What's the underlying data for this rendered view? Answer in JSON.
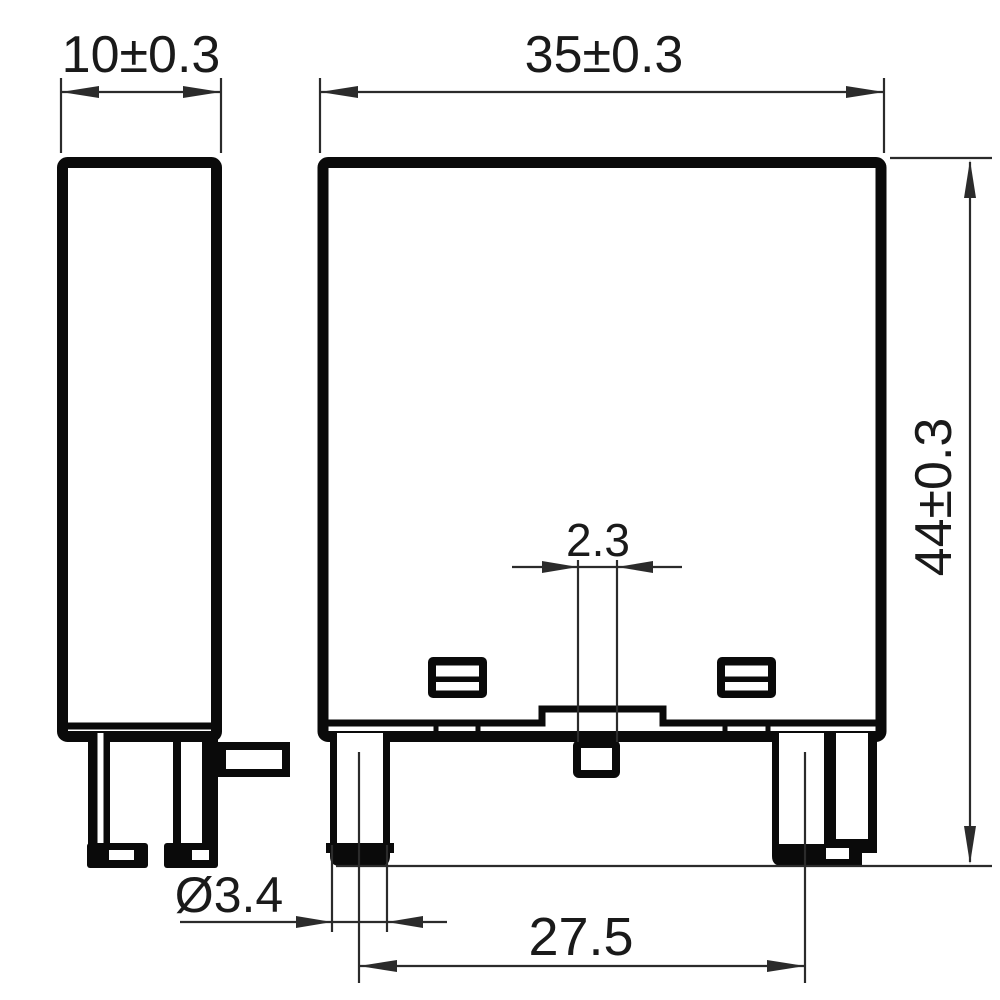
{
  "drawing": {
    "title": "relay-module-dimension-drawing",
    "background_color": "#ffffff",
    "outline_color": "#0a0a0a",
    "dimension_line_color": "#2b2b2b",
    "dimensions": {
      "side_width": {
        "label": "10±0.3"
      },
      "front_width": {
        "label": "35±0.3"
      },
      "overall_height": {
        "label": "44±0.3"
      },
      "center_pin_width": {
        "label": "2.3"
      },
      "pin_diameter": {
        "label": "Ø3.4"
      },
      "pin_pitch": {
        "label": "27.5"
      }
    }
  }
}
